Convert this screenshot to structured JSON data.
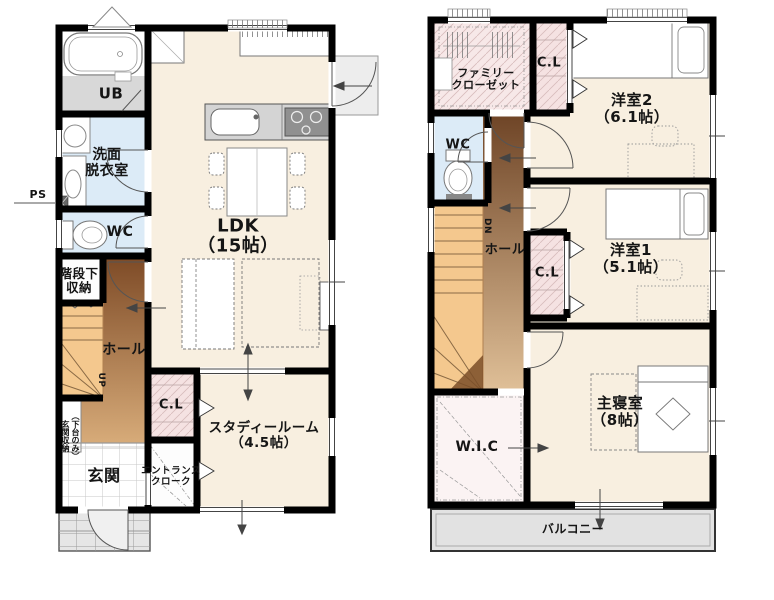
{
  "floor1": {
    "ub": "UB",
    "washroom": "洗面\n脱衣室",
    "ps": "PS",
    "wc": "WC",
    "under_stair_storage": "階段下\n収納",
    "hall": "ホール",
    "stairs_up": "UP",
    "ldk": "LDK\n（15帖）",
    "closet": "C.L",
    "study_room": "スタディールーム\n（4.5帖）",
    "entrance": "玄関",
    "entrance_cloak": "エントランス\nクローク",
    "entrance_storage": "玄関収納\n（下台のみ）"
  },
  "floor2": {
    "family_closet": "ファミリー\nクローゼット",
    "closet_top": "C.L",
    "bedroom2": "洋室2\n（6.1帖）",
    "wc": "WC",
    "stairs_down": "DN",
    "hall": "ホール",
    "closet_mid": "C.L",
    "bedroom1": "洋室1\n（5.1帖）",
    "wic": "W.I.C",
    "master_bedroom": "主寝室\n（8帖）",
    "balcony": "バルコニー"
  },
  "colors": {
    "wall": "#000000",
    "room_cream": "#f8efe0",
    "wet_blue": "#dcebf7",
    "closet_pink": "#f5e2e2",
    "stair_orange": "#f4c88e",
    "hall_brown_dark": "#8a5531",
    "hall_brown_light": "#d7ab79",
    "balcony_grey": "#e2e2e2"
  }
}
